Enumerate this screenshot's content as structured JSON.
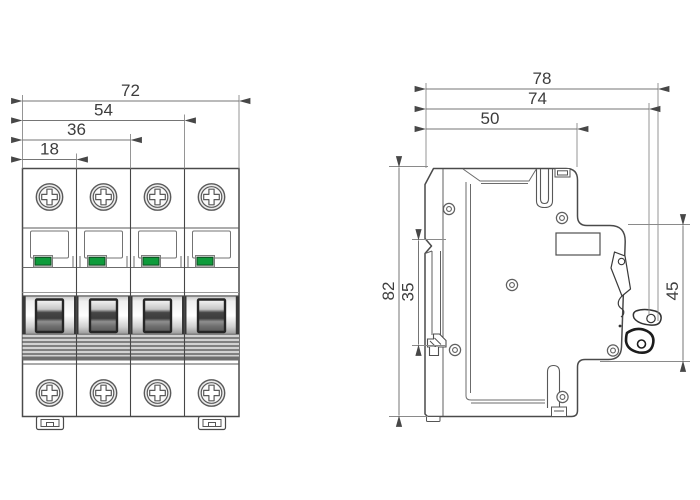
{
  "front_view": {
    "dim_total_width": "72",
    "dim_three_poles": "54",
    "dim_two_poles": "36",
    "dim_one_pole": "18"
  },
  "side_view": {
    "dim_depth_overall": "78",
    "dim_depth_to_latch": "74",
    "dim_top_face_depth": "50",
    "dim_height_overall": "82",
    "dim_din_recess": "35",
    "dim_front_height": "45"
  },
  "colors": {
    "outline": "#4a4a4a",
    "dimension_line": "#757575",
    "dimension_text": "#3d3d3d",
    "indicator_green": "#0e9b3b",
    "indicator_green_border": "#0d4a1f",
    "handle_dark": "#2a2a2a"
  }
}
